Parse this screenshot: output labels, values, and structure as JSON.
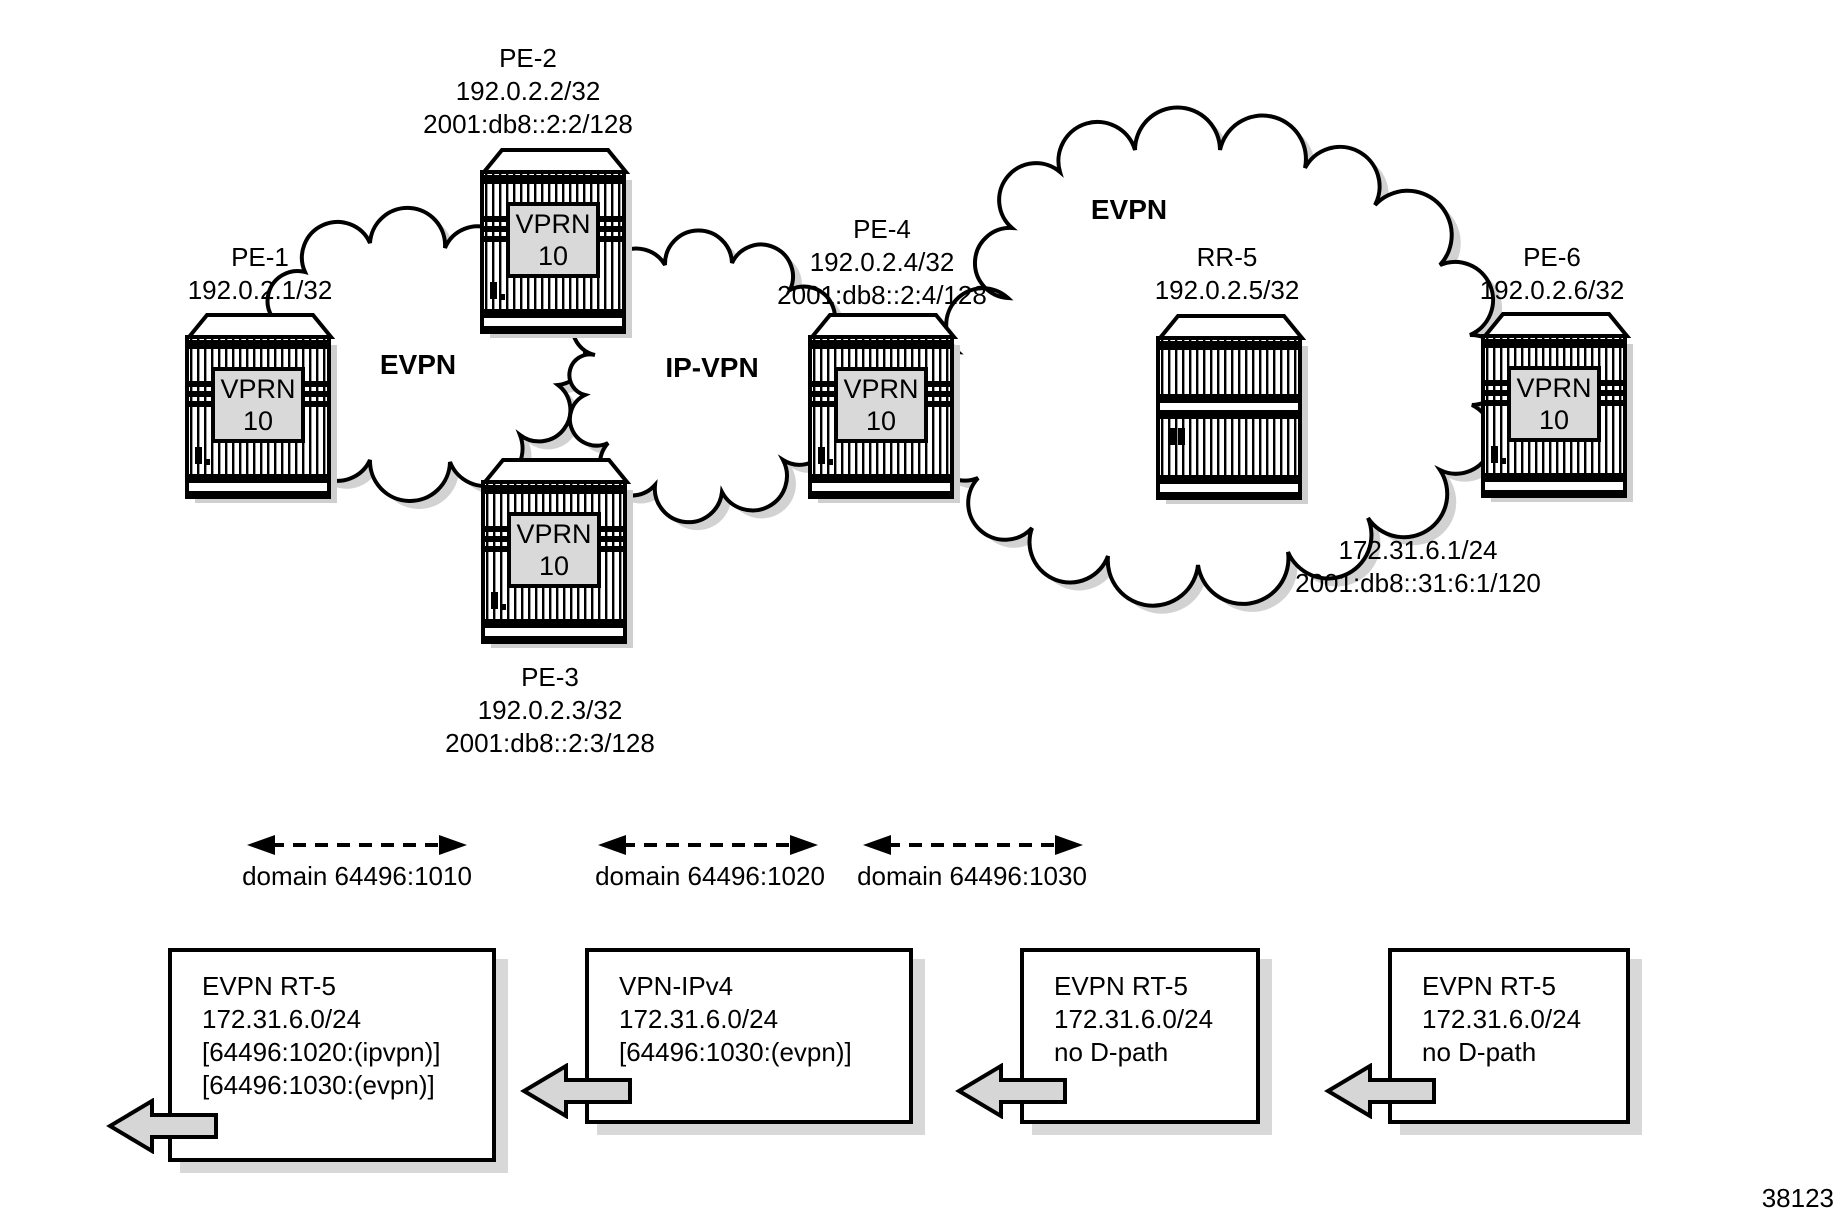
{
  "figure": {
    "number": "38123"
  },
  "nodes": {
    "pe1": {
      "name": "PE-1",
      "ipv4": "192.0.2.1/32",
      "service": "VPRN",
      "service_id": "10"
    },
    "pe2": {
      "name": "PE-2",
      "ipv4": "192.0.2.2/32",
      "ipv6": "2001:db8::2:2/128",
      "service": "VPRN",
      "service_id": "10"
    },
    "pe3": {
      "name": "PE-3",
      "ipv4": "192.0.2.3/32",
      "ipv6": "2001:db8::2:3/128",
      "service": "VPRN",
      "service_id": "10"
    },
    "pe4": {
      "name": "PE-4",
      "ipv4": "192.0.2.4/32",
      "ipv6": "2001:db8::2:4/128",
      "service": "VPRN",
      "service_id": "10"
    },
    "rr5": {
      "name": "RR-5",
      "ipv4": "192.0.2.5/32"
    },
    "pe6": {
      "name": "PE-6",
      "ipv4": "192.0.2.6/32",
      "service": "VPRN",
      "service_id": "10",
      "access_ipv4": "172.31.6.1/24",
      "access_ipv6": "2001:db8::31:6:1/120"
    }
  },
  "clouds": {
    "evpn_left": {
      "label": "EVPN"
    },
    "ipvpn": {
      "label": "IP-VPN"
    },
    "evpn_right": {
      "label": "EVPN"
    }
  },
  "domains": [
    {
      "label": "domain 64496:1010"
    },
    {
      "label": "domain 64496:1020"
    },
    {
      "label": "domain 64496:1030"
    }
  ],
  "route_boxes": [
    {
      "lines": [
        "EVPN RT-5",
        "172.31.6.0/24",
        "[64496:1020:(ipvpn)]",
        "[64496:1030:(evpn)]"
      ]
    },
    {
      "lines": [
        "VPN-IPv4",
        "172.31.6.0/24",
        "[64496:1030:(evpn)]"
      ]
    },
    {
      "lines": [
        "EVPN RT-5",
        "172.31.6.0/24",
        "no D-path"
      ]
    },
    {
      "lines": [
        "EVPN RT-5",
        "172.31.6.0/24",
        "no D-path"
      ]
    }
  ],
  "colors": {
    "line": "#000000",
    "service_box_fill": "#d9d9d9",
    "block_arrow_fill": "#d6d6d6",
    "shadow": "#d2d2d2"
  }
}
